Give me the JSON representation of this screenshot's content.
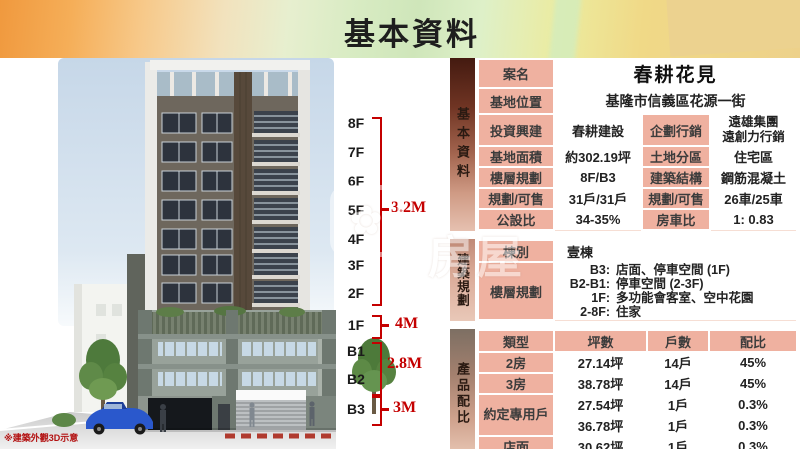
{
  "header": {
    "title": "基本資料"
  },
  "photo": {
    "caption": "※建築外觀3D示意"
  },
  "floor_scale": {
    "floors": [
      "8F",
      "7F",
      "6F",
      "5F",
      "4F",
      "3F",
      "2F",
      "1F",
      "B1",
      "B2",
      "B3"
    ],
    "dims": {
      "upper": "3.2M",
      "first": "4M",
      "basement": "2.8M",
      "b3": "3M"
    }
  },
  "watermark": {
    "text": "房屋"
  },
  "sections": {
    "basic": {
      "sidebar": "基本資料",
      "rows": [
        {
          "label": "案名",
          "value": "春耕花見"
        },
        {
          "label": "基地位置",
          "value": "基隆市信義區花源一街"
        },
        {
          "label": "投資興建",
          "value": "春耕建設",
          "label2": "企劃行銷",
          "value2a": "遠雄集團",
          "value2b": "遠創力行銷"
        },
        {
          "label": "基地面積",
          "value": "約302.19坪",
          "label2": "土地分區",
          "value2": "住宅區"
        },
        {
          "label": "樓層規劃",
          "value": "8F/B3",
          "label2": "建築結構",
          "value2": "鋼筋混凝土"
        },
        {
          "label": "規劃/可售",
          "value": "31戶/31戶",
          "label2": "規劃/可售",
          "value2": "26車/25車"
        },
        {
          "label": "公設比",
          "value": "34-35%",
          "label2": "房車比",
          "value2": "1: 0.83"
        }
      ]
    },
    "plan": {
      "sidebar": "建築規劃",
      "dong_label": "棟別",
      "dong_value": "壹棟",
      "floors_label": "樓層規劃",
      "floor_lines": [
        {
          "k": "B3:",
          "v": "店面、停車空間 (1F)"
        },
        {
          "k": "B2-B1:",
          "v": "停車空間 (2-3F)"
        },
        {
          "k": "1F:",
          "v": "多功能會客室、空中花園"
        },
        {
          "k": "2-8F:",
          "v": "住家"
        }
      ]
    },
    "product": {
      "sidebar": "產品配比",
      "headers": [
        "類型",
        "坪數",
        "戶數",
        "配比"
      ],
      "rows": [
        {
          "type": "2房",
          "area": "27.14坪",
          "units": "14戶",
          "ratio": "45%"
        },
        {
          "type": "3房",
          "area": "38.78坪",
          "units": "14戶",
          "ratio": "45%"
        },
        {
          "type": "約定專用戶",
          "area": "27.54坪",
          "units": "1戶",
          "ratio": "0.3%"
        },
        {
          "area": "36.78坪",
          "units": "1戶",
          "ratio": "0.3%"
        },
        {
          "type": "店面",
          "area": "30.62坪",
          "units": "1戶",
          "ratio": "0.3%"
        }
      ]
    }
  },
  "colors": {
    "accent_red": "#c40000",
    "cell_pink": "#efb1a0",
    "sidebar_dark": "#441a10",
    "banner_orange": "#f0993e",
    "banner_yellow": "#edd18a"
  }
}
